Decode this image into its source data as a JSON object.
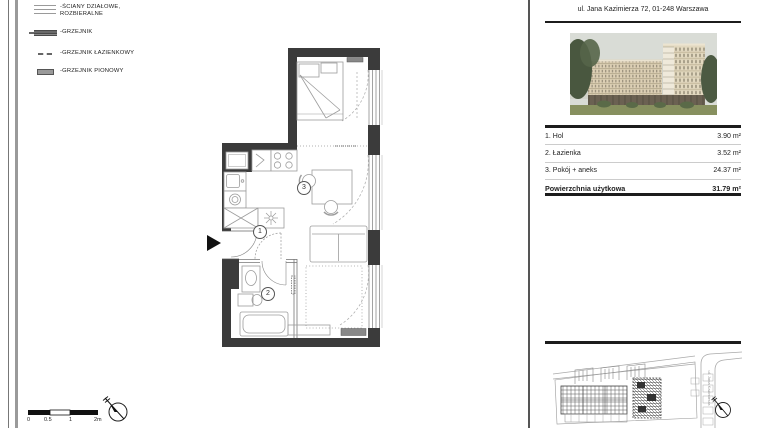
{
  "legend": {
    "items": [
      {
        "line1": "-ŚCIANY DZIAŁOWE,",
        "line2": "ROZBIERALNE"
      },
      {
        "line1": "-GRZEJNIK",
        "line2": ""
      },
      {
        "line1": "-GRZEJNIK ŁAZIENKOWY",
        "line2": ""
      },
      {
        "line1": "-GRZEJNIK PIONOWY",
        "line2": ""
      }
    ]
  },
  "header": {
    "address": "ul. Jana Kazimierza 72, 01-248 Warszawa"
  },
  "plan": {
    "room_labels": {
      "hol": "1",
      "lazienka": "2",
      "pokoj": "3"
    }
  },
  "area_table": {
    "rows": [
      {
        "name": "1. Hol",
        "area": "3.90 m²"
      },
      {
        "name": "2. Łazienka",
        "area": "3.52 m²"
      },
      {
        "name": "3. Pokój + aneks",
        "area": "24.37 m²"
      }
    ],
    "total_label": "Powierzchnia użytkowa",
    "total_area": "31.79 m²"
  },
  "scale_bar": {
    "ticks": [
      "0",
      "0.5",
      "1",
      "2m"
    ]
  },
  "site_plan": {
    "street_label": "ul. Jana Kazimierza"
  },
  "colors": {
    "wall": "#3b3b3b",
    "thin_line": "#9c9c9c",
    "rule": "#1c1c1c"
  }
}
